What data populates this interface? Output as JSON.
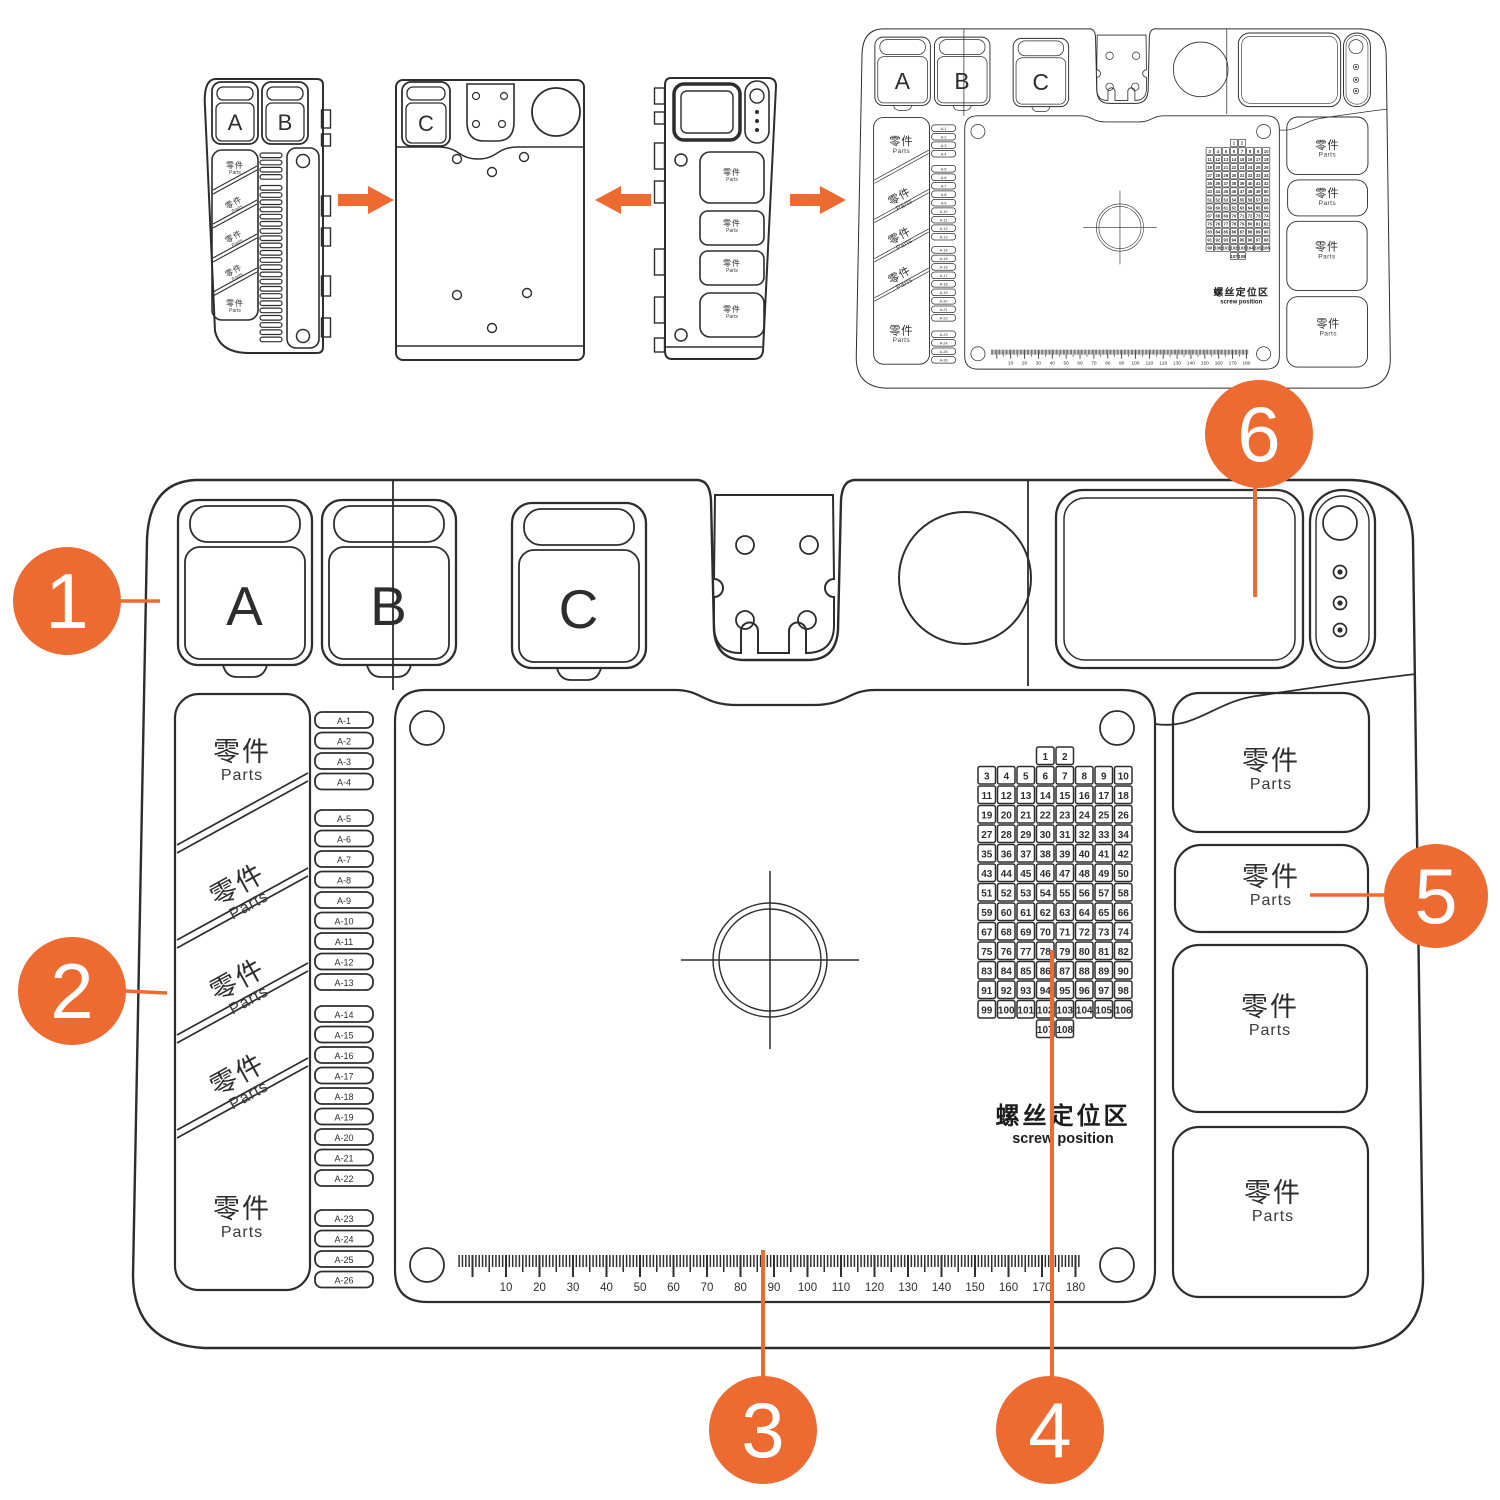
{
  "colors": {
    "accent": "#ED6A30",
    "ink": "#2D2D2D"
  },
  "labels": {
    "tray_a": "A",
    "tray_b": "B",
    "tray_c": "C",
    "parts_cn": "零件",
    "parts_en": "Parts",
    "screw_zone_cn": "螺丝定位区",
    "screw_zone_en": "screw position"
  },
  "callouts": [
    {
      "number": "1"
    },
    {
      "number": "2"
    },
    {
      "number": "3"
    },
    {
      "number": "4"
    },
    {
      "number": "5"
    },
    {
      "number": "6"
    }
  ],
  "slot_labels": [
    "A-1",
    "A-2",
    "A-3",
    "A-4",
    "A-5",
    "A-6",
    "A-7",
    "A-8",
    "A-9",
    "A-10",
    "A-11",
    "A-12",
    "A-13",
    "A-14",
    "A-15",
    "A-16",
    "A-17",
    "A-18",
    "A-19",
    "A-20",
    "A-21",
    "A-22",
    "A-23",
    "A-24",
    "A-25",
    "A-26"
  ],
  "screw_grid": {
    "numbers": [
      1,
      2,
      3,
      4,
      5,
      6,
      7,
      8,
      9,
      10,
      11,
      12,
      13,
      14,
      15,
      16,
      17,
      18,
      19,
      20,
      21,
      22,
      23,
      24,
      25,
      26,
      27,
      28,
      29,
      30,
      31,
      32,
      33,
      34,
      35,
      36,
      37,
      38,
      39,
      40,
      41,
      42,
      43,
      44,
      45,
      46,
      47,
      48,
      49,
      50,
      51,
      52,
      53,
      54,
      55,
      56,
      57,
      58,
      59,
      60,
      61,
      62,
      63,
      64,
      65,
      66,
      67,
      68,
      69,
      70,
      71,
      72,
      73,
      74,
      75,
      76,
      77,
      78,
      79,
      80,
      81,
      82,
      83,
      84,
      85,
      86,
      87,
      88,
      89,
      90,
      91,
      92,
      93,
      94,
      95,
      96,
      97,
      98,
      99,
      100,
      101,
      102,
      103,
      104,
      105,
      106,
      107,
      108
    ]
  },
  "ruler": {
    "tick_labels": [
      "10",
      "20",
      "30",
      "40",
      "50",
      "60",
      "70",
      "80",
      "90",
      "100",
      "110",
      "120",
      "130",
      "140",
      "150",
      "160",
      "170",
      "180"
    ]
  }
}
